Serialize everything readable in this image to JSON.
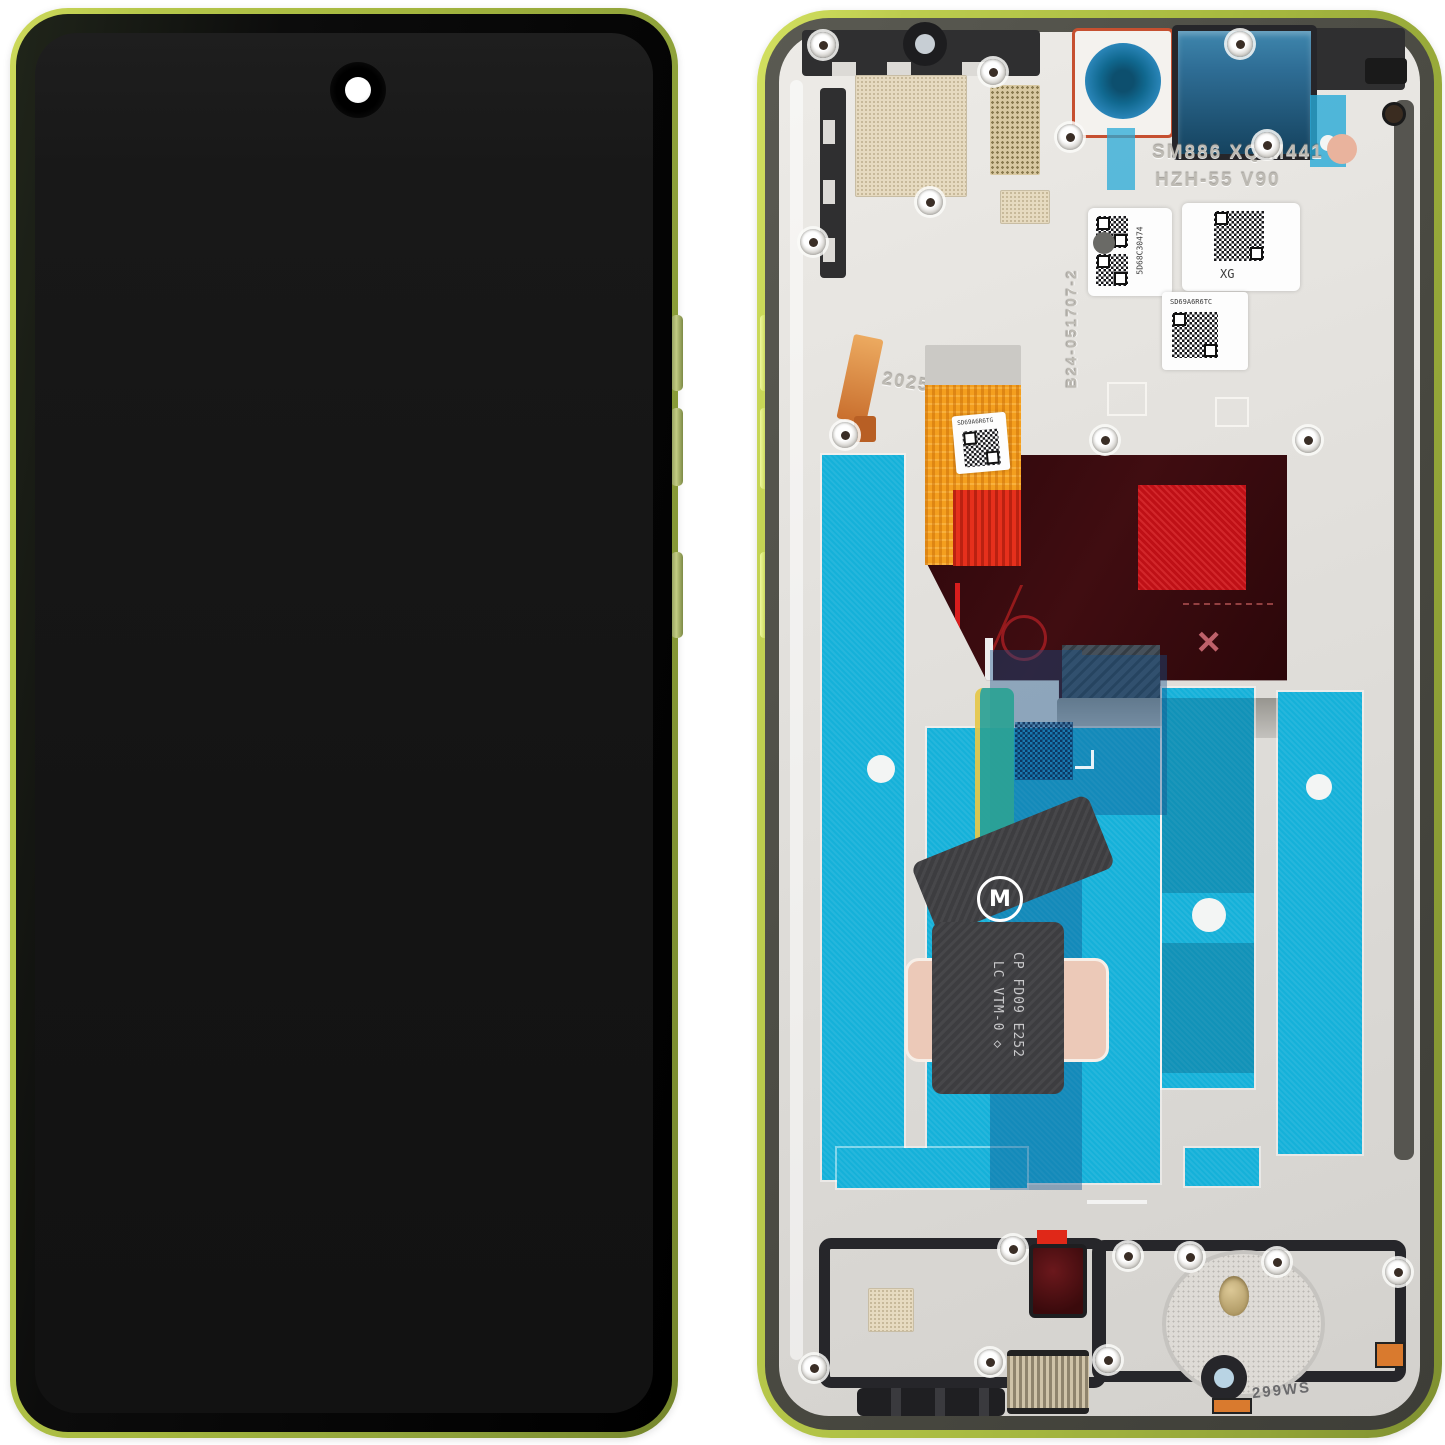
{
  "product": {
    "title": "Smartphone LCD display assembly with lime-green frame — front and back views"
  },
  "back_view": {
    "engravings": {
      "model_line1": "SM886 XQ M441",
      "model_line2": "HZH-55 V90",
      "serial_vertical": "B24-051707-2",
      "year": "2025",
      "bottom_code": "299WS"
    },
    "stickers": {
      "label_left": "5D68C30474",
      "label_right": "XG",
      "label_mid": "SD69A6R6TC",
      "label_flex": "SD69A6R6TG"
    },
    "flex": {
      "line1": "CP FD09 E252",
      "line2": "LC VTM-0 ◇",
      "logo_letter": "M"
    }
  },
  "colors": {
    "frame_green": "#b8c94a",
    "frame_olive": "#7f9030",
    "gasket_gray": "#4d4d47",
    "body_silver": "#e3e1dd",
    "film_cyan": "#15b1d9",
    "flex_orange": "#f49f1f",
    "flex_red": "#e6301c",
    "panel_maroon": "#330a0e",
    "panel_red_mesh": "#bf1016",
    "pad_pink": "#ecc9b8",
    "copper": "#cf7a3a",
    "teal_strip": "#2ca295",
    "screen_black": "#161616"
  }
}
